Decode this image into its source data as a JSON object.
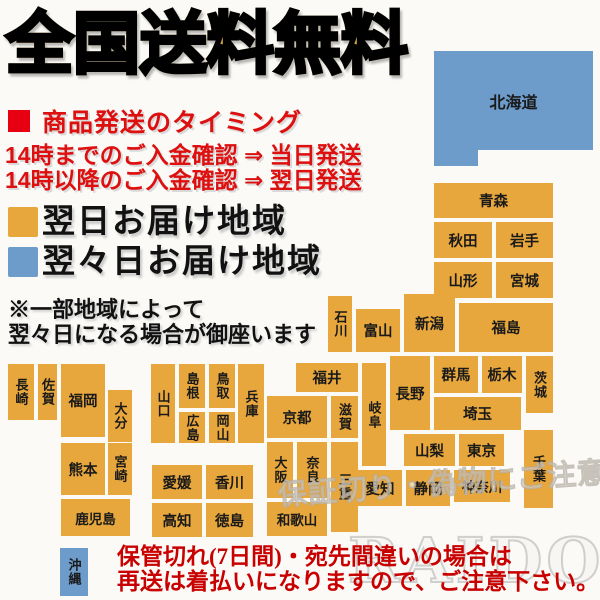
{
  "title": "全国送料無料",
  "shipping": {
    "heading": "商品発送のタイミング",
    "line1": "14時までのご入金確認 ⇒ 当日発送",
    "line2": "14時以降のご入金確認 ⇒ 翌日発送"
  },
  "legend": {
    "next_day_label": "翌日お届け地域",
    "two_day_label": "翌々日お届け地域"
  },
  "note": {
    "line1": "※一部地域によって",
    "line2": "翌々日になる場合が御座います"
  },
  "warning": {
    "line1": "保管切れ(7日間)・宛先間違いの場合は",
    "line2": "再送は着払いになりますので、ご注意下さい。"
  },
  "watermarks": {
    "caution": "保証切り・偽物にご注意下さい",
    "brand": "RAIDOU"
  },
  "colors": {
    "orange": "#e8a73c",
    "blue": "#6d9bca",
    "red_square": "#e60012"
  },
  "map": {
    "regions": [
      {
        "id": "hokkaido",
        "label": "北海道",
        "x": 434,
        "y": 51,
        "w": 159,
        "h": 99,
        "color": "blue",
        "orient": "h"
      },
      {
        "id": "hokkaido-foot",
        "label": "",
        "x": 434,
        "y": 150,
        "w": 44,
        "h": 16,
        "color": "blue",
        "orient": "h"
      },
      {
        "id": "aomori",
        "label": "青森",
        "x": 434,
        "y": 183,
        "w": 119,
        "h": 35,
        "color": "orange",
        "orient": "h"
      },
      {
        "id": "akita",
        "label": "秋田",
        "x": 434,
        "y": 222,
        "w": 58,
        "h": 36,
        "color": "orange",
        "orient": "h"
      },
      {
        "id": "iwate",
        "label": "岩手",
        "x": 496,
        "y": 222,
        "w": 57,
        "h": 36,
        "color": "orange",
        "orient": "h"
      },
      {
        "id": "yamagata",
        "label": "山形",
        "x": 434,
        "y": 262,
        "w": 58,
        "h": 36,
        "color": "orange",
        "orient": "h"
      },
      {
        "id": "miyagi",
        "label": "宮城",
        "x": 496,
        "y": 262,
        "w": 57,
        "h": 36,
        "color": "orange",
        "orient": "h"
      },
      {
        "id": "niigata",
        "label": "新潟",
        "x": 404,
        "y": 294,
        "w": 51,
        "h": 58,
        "color": "orange",
        "orient": "h"
      },
      {
        "id": "ishikawa",
        "label": "石川",
        "x": 328,
        "y": 296,
        "w": 24,
        "h": 56,
        "color": "orange",
        "orient": "v"
      },
      {
        "id": "toyama",
        "label": "富山",
        "x": 356,
        "y": 309,
        "w": 44,
        "h": 43,
        "color": "orange",
        "orient": "h"
      },
      {
        "id": "fukushima",
        "label": "福島",
        "x": 459,
        "y": 303,
        "w": 94,
        "h": 49,
        "color": "orange",
        "orient": "h"
      },
      {
        "id": "gunma",
        "label": "群馬",
        "x": 434,
        "y": 356,
        "w": 44,
        "h": 37,
        "color": "orange",
        "orient": "h"
      },
      {
        "id": "tochigi",
        "label": "栃木",
        "x": 482,
        "y": 356,
        "w": 40,
        "h": 37,
        "color": "orange",
        "orient": "h"
      },
      {
        "id": "ibaraki",
        "label": "茨城",
        "x": 526,
        "y": 356,
        "w": 27,
        "h": 57,
        "color": "orange",
        "orient": "v"
      },
      {
        "id": "nagano",
        "label": "長野",
        "x": 390,
        "y": 356,
        "w": 40,
        "h": 74,
        "color": "orange",
        "orient": "h"
      },
      {
        "id": "saitama",
        "label": "埼玉",
        "x": 434,
        "y": 397,
        "w": 87,
        "h": 33,
        "color": "orange",
        "orient": "h"
      },
      {
        "id": "fukui",
        "label": "福井",
        "x": 296,
        "y": 363,
        "w": 62,
        "h": 29,
        "color": "orange",
        "orient": "h"
      },
      {
        "id": "gifu",
        "label": "岐阜",
        "x": 362,
        "y": 363,
        "w": 24,
        "h": 103,
        "color": "orange",
        "orient": "v"
      },
      {
        "id": "kyoto",
        "label": "京都",
        "x": 267,
        "y": 396,
        "w": 60,
        "h": 42,
        "color": "orange",
        "orient": "h"
      },
      {
        "id": "shiga",
        "label": "滋賀",
        "x": 331,
        "y": 396,
        "w": 27,
        "h": 42,
        "color": "orange",
        "orient": "v"
      },
      {
        "id": "yamanashi",
        "label": "山梨",
        "x": 404,
        "y": 434,
        "w": 51,
        "h": 32,
        "color": "orange",
        "orient": "h"
      },
      {
        "id": "tokyo",
        "label": "東京",
        "x": 459,
        "y": 434,
        "w": 45,
        "h": 32,
        "color": "orange",
        "orient": "h"
      },
      {
        "id": "chiba",
        "label": "千葉",
        "x": 524,
        "y": 430,
        "w": 29,
        "h": 78,
        "color": "orange",
        "orient": "v"
      },
      {
        "id": "osaka",
        "label": "大阪",
        "x": 267,
        "y": 442,
        "w": 26,
        "h": 56,
        "color": "orange",
        "orient": "v"
      },
      {
        "id": "nara",
        "label": "奈良",
        "x": 297,
        "y": 442,
        "w": 30,
        "h": 56,
        "color": "orange",
        "orient": "v"
      },
      {
        "id": "mie",
        "label": "三重",
        "x": 331,
        "y": 442,
        "w": 27,
        "h": 90,
        "color": "orange",
        "orient": "v"
      },
      {
        "id": "wakayama",
        "label": "和歌山",
        "x": 267,
        "y": 502,
        "w": 60,
        "h": 34,
        "color": "orange",
        "orient": "h"
      },
      {
        "id": "aichi",
        "label": "愛知",
        "x": 358,
        "y": 470,
        "w": 44,
        "h": 36,
        "color": "orange",
        "orient": "h"
      },
      {
        "id": "shizuoka",
        "label": "静岡",
        "x": 406,
        "y": 470,
        "w": 44,
        "h": 36,
        "color": "orange",
        "orient": "h"
      },
      {
        "id": "kanagawa",
        "label": "神奈川",
        "x": 454,
        "y": 470,
        "w": 56,
        "h": 32,
        "color": "orange",
        "orient": "h"
      },
      {
        "id": "yamaguchi",
        "label": "山口",
        "x": 151,
        "y": 364,
        "w": 24,
        "h": 79,
        "color": "orange",
        "orient": "v"
      },
      {
        "id": "shimane",
        "label": "島根",
        "x": 179,
        "y": 364,
        "w": 26,
        "h": 44,
        "color": "orange",
        "orient": "v"
      },
      {
        "id": "tottori",
        "label": "鳥取",
        "x": 209,
        "y": 364,
        "w": 26,
        "h": 44,
        "color": "orange",
        "orient": "v"
      },
      {
        "id": "hiroshima",
        "label": "広島",
        "x": 179,
        "y": 412,
        "w": 26,
        "h": 31,
        "color": "orange",
        "orient": "v"
      },
      {
        "id": "okayama",
        "label": "岡山",
        "x": 209,
        "y": 412,
        "w": 26,
        "h": 31,
        "color": "orange",
        "orient": "v"
      },
      {
        "id": "hyogo",
        "label": "兵庫",
        "x": 238,
        "y": 364,
        "w": 26,
        "h": 79,
        "color": "orange",
        "orient": "v"
      },
      {
        "id": "nagasaki",
        "label": "長崎",
        "x": 8,
        "y": 364,
        "w": 26,
        "h": 56,
        "color": "orange",
        "orient": "v"
      },
      {
        "id": "saga",
        "label": "佐賀",
        "x": 38,
        "y": 364,
        "w": 19,
        "h": 56,
        "color": "orange",
        "orient": "v"
      },
      {
        "id": "fukuoka",
        "label": "福岡",
        "x": 61,
        "y": 364,
        "w": 44,
        "h": 73,
        "color": "orange",
        "orient": "h"
      },
      {
        "id": "oita",
        "label": "大分",
        "x": 108,
        "y": 390,
        "w": 24,
        "h": 52,
        "color": "orange",
        "orient": "v"
      },
      {
        "id": "kumamoto",
        "label": "熊本",
        "x": 61,
        "y": 443,
        "w": 44,
        "h": 52,
        "color": "orange",
        "orient": "h"
      },
      {
        "id": "miyazaki",
        "label": "宮崎",
        "x": 108,
        "y": 443,
        "w": 24,
        "h": 52,
        "color": "orange",
        "orient": "v"
      },
      {
        "id": "kagoshima",
        "label": "鹿児島",
        "x": 61,
        "y": 499,
        "w": 69,
        "h": 37,
        "color": "orange",
        "orient": "h"
      },
      {
        "id": "ehime",
        "label": "愛媛",
        "x": 152,
        "y": 465,
        "w": 50,
        "h": 34,
        "color": "orange",
        "orient": "h"
      },
      {
        "id": "kagawa",
        "label": "香川",
        "x": 206,
        "y": 465,
        "w": 47,
        "h": 34,
        "color": "orange",
        "orient": "h"
      },
      {
        "id": "kochi",
        "label": "高知",
        "x": 152,
        "y": 503,
        "w": 50,
        "h": 34,
        "color": "orange",
        "orient": "h"
      },
      {
        "id": "tokushima",
        "label": "徳島",
        "x": 206,
        "y": 503,
        "w": 47,
        "h": 34,
        "color": "orange",
        "orient": "h"
      },
      {
        "id": "okinawa",
        "label": "沖縄",
        "x": 60,
        "y": 548,
        "w": 28,
        "h": 48,
        "color": "blue",
        "orient": "v"
      }
    ]
  }
}
